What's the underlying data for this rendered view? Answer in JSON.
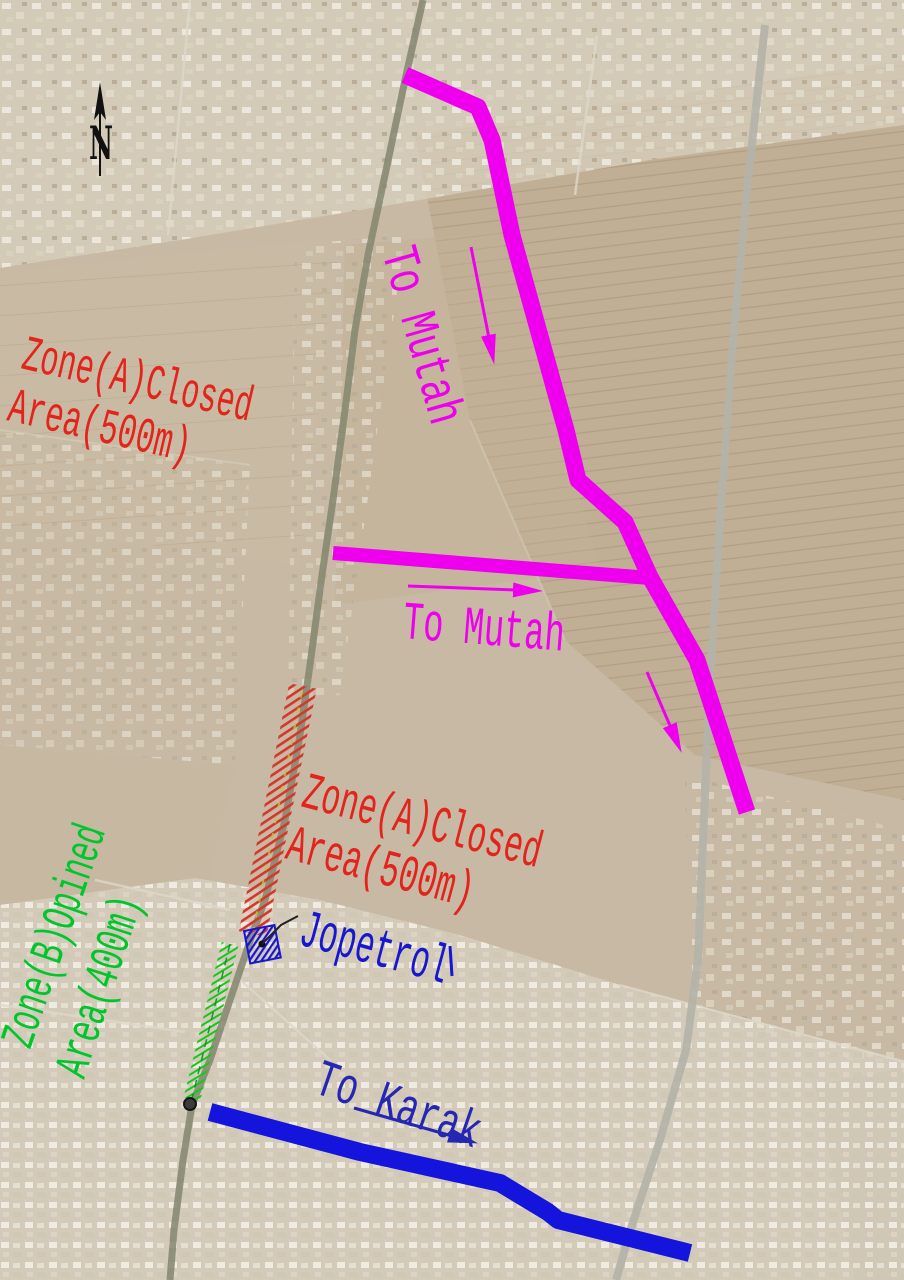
{
  "annotations": {
    "north_label": "N",
    "zone_a_left": {
      "line1": "Zone(A)Closed",
      "line2": "Area(500m)"
    },
    "zone_a_road": {
      "line1": "Zone(A)Closed",
      "line2": "Area(500m)"
    },
    "zone_b_road": {
      "line1": "Zone(B)Opined",
      "line2": "Area(400m)"
    },
    "route_to_mutah_main": "To Mutah",
    "route_to_mutah_branch": "To Mutah",
    "route_to_karak": "To Karak",
    "facility_label": "Jopetrol",
    "colors": {
      "mutah_route": "#ee00ee",
      "karak_route": "#1414dd",
      "karak_label": "#2626b4",
      "zone_a_label": "#e3231c",
      "zone_a_hatch": "#d6362b",
      "zone_b_label": "#00c62e",
      "zone_b_hatch": "#16c81e",
      "facility": "#1717cf",
      "north": "#111111"
    }
  }
}
